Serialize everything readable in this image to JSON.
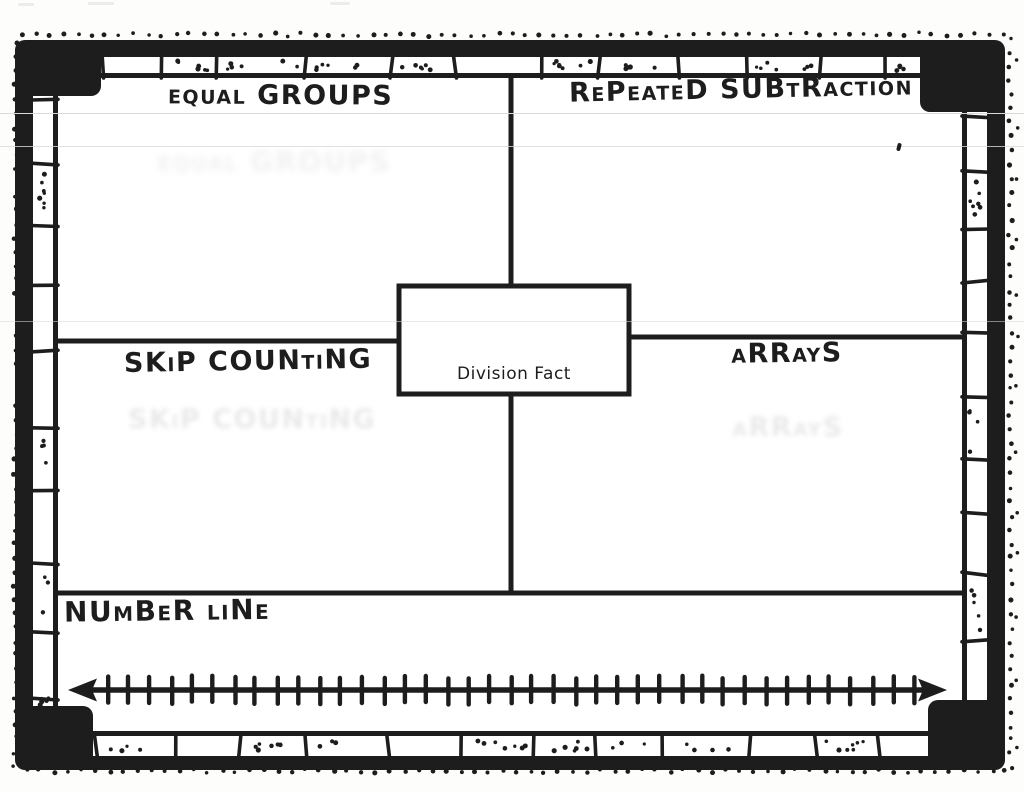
{
  "colors": {
    "ink": "#1d1d1d",
    "paper": "#ffffff"
  },
  "organizer": {
    "center_box": {
      "label": "Division Fact"
    },
    "quadrants": [
      {
        "position": "top-left",
        "label": "equal GROUPS"
      },
      {
        "position": "top-right",
        "label": "RePeateD SUBtRaction"
      },
      {
        "position": "middle-left",
        "label": "SKiP COUNtiNG"
      },
      {
        "position": "middle-right",
        "label": "aRRayS"
      }
    ],
    "number_line_section": {
      "label": "NUmBeR liNe",
      "number_line": {
        "tick_count": 39,
        "arrows": "both-ends"
      }
    }
  }
}
